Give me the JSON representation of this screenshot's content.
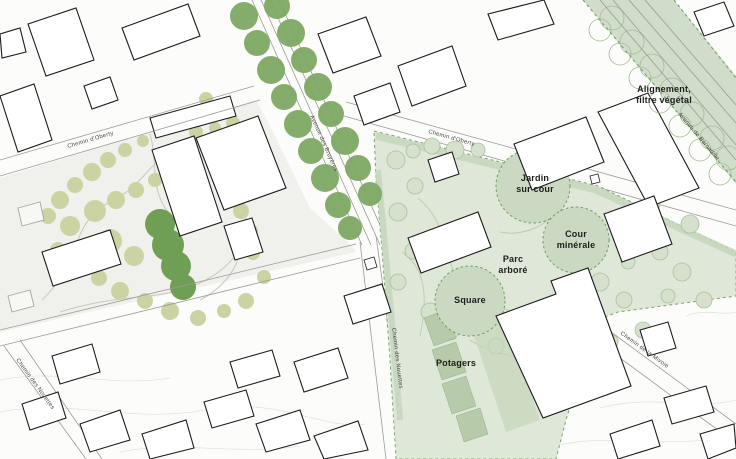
{
  "map": {
    "area_labels": {
      "alignement_line1": "Alignement,",
      "alignement_line2": "filtre végétal",
      "jardin_line1": "Jardin",
      "jardin_line2": "sur cour",
      "cour_line1": "Cour",
      "cour_line2": "minérale",
      "parc_line1": "Parc",
      "parc_line2": "arboré",
      "square": "Square",
      "potagers": "Potagers"
    },
    "street_labels": {
      "chemin_oberty_left": "Chemin d'Oberty",
      "chemin_oberty_right": "Chemin d'Oberty",
      "avenue_central": "Avenue des Bruyères",
      "avenue_band": "Avenue de Bernadille",
      "chemin_bottom_left": "Chemin des Nouettes",
      "chemin_bottom_center": "Chemin des Nouettes",
      "chemin_mivoie": "Chemin de la Mivoie"
    },
    "colors": {
      "avenue_tree_green": "#7da963",
      "existing_tree_olive": "#ccd3a3",
      "dense_tree_green": "#6f9f55",
      "project_zone_fill": "#dee7d8",
      "feature_circle_fill": "#cbd9c2",
      "dashed_boundary_green": "#6f9c62",
      "band_fill": "#ccdac5",
      "label_text": "#1d1d1b"
    }
  }
}
